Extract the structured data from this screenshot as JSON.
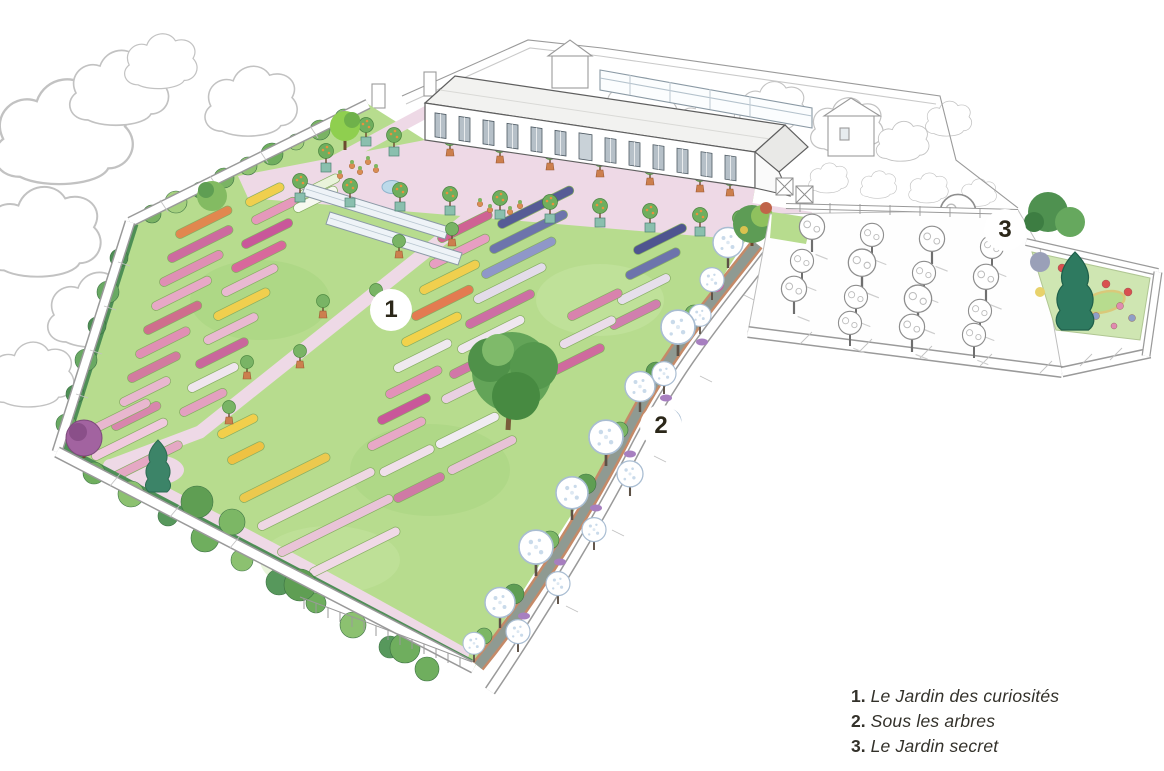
{
  "legend": {
    "items": [
      {
        "number": "1.",
        "label": "Le Jardin des curiosités"
      },
      {
        "number": "2.",
        "label": "Sous les arbres"
      },
      {
        "number": "3.",
        "label": "Le Jardin secret"
      }
    ]
  },
  "markers": [
    {
      "label": "1",
      "area": "Le Jardin des curiosités"
    },
    {
      "label": "2",
      "area": "Sous les arbres"
    },
    {
      "label": "3",
      "area": "Le Jardin secret"
    }
  ],
  "palette": {
    "lawn": "#b7dc8e",
    "path_pink": "#eed9e6",
    "hedge_green": "#4e8f55",
    "bed_magenta": "#c9579a",
    "bed_blue": "#565c96",
    "bed_yellow": "#f0cf4e",
    "allee_path": "#8f9a92",
    "allee_edge": "#c58a68",
    "wall_line": "#9a9a9a",
    "marker_bg": "#ffffff",
    "marker_text": "#2b2719",
    "legend_text": "#33312a"
  }
}
